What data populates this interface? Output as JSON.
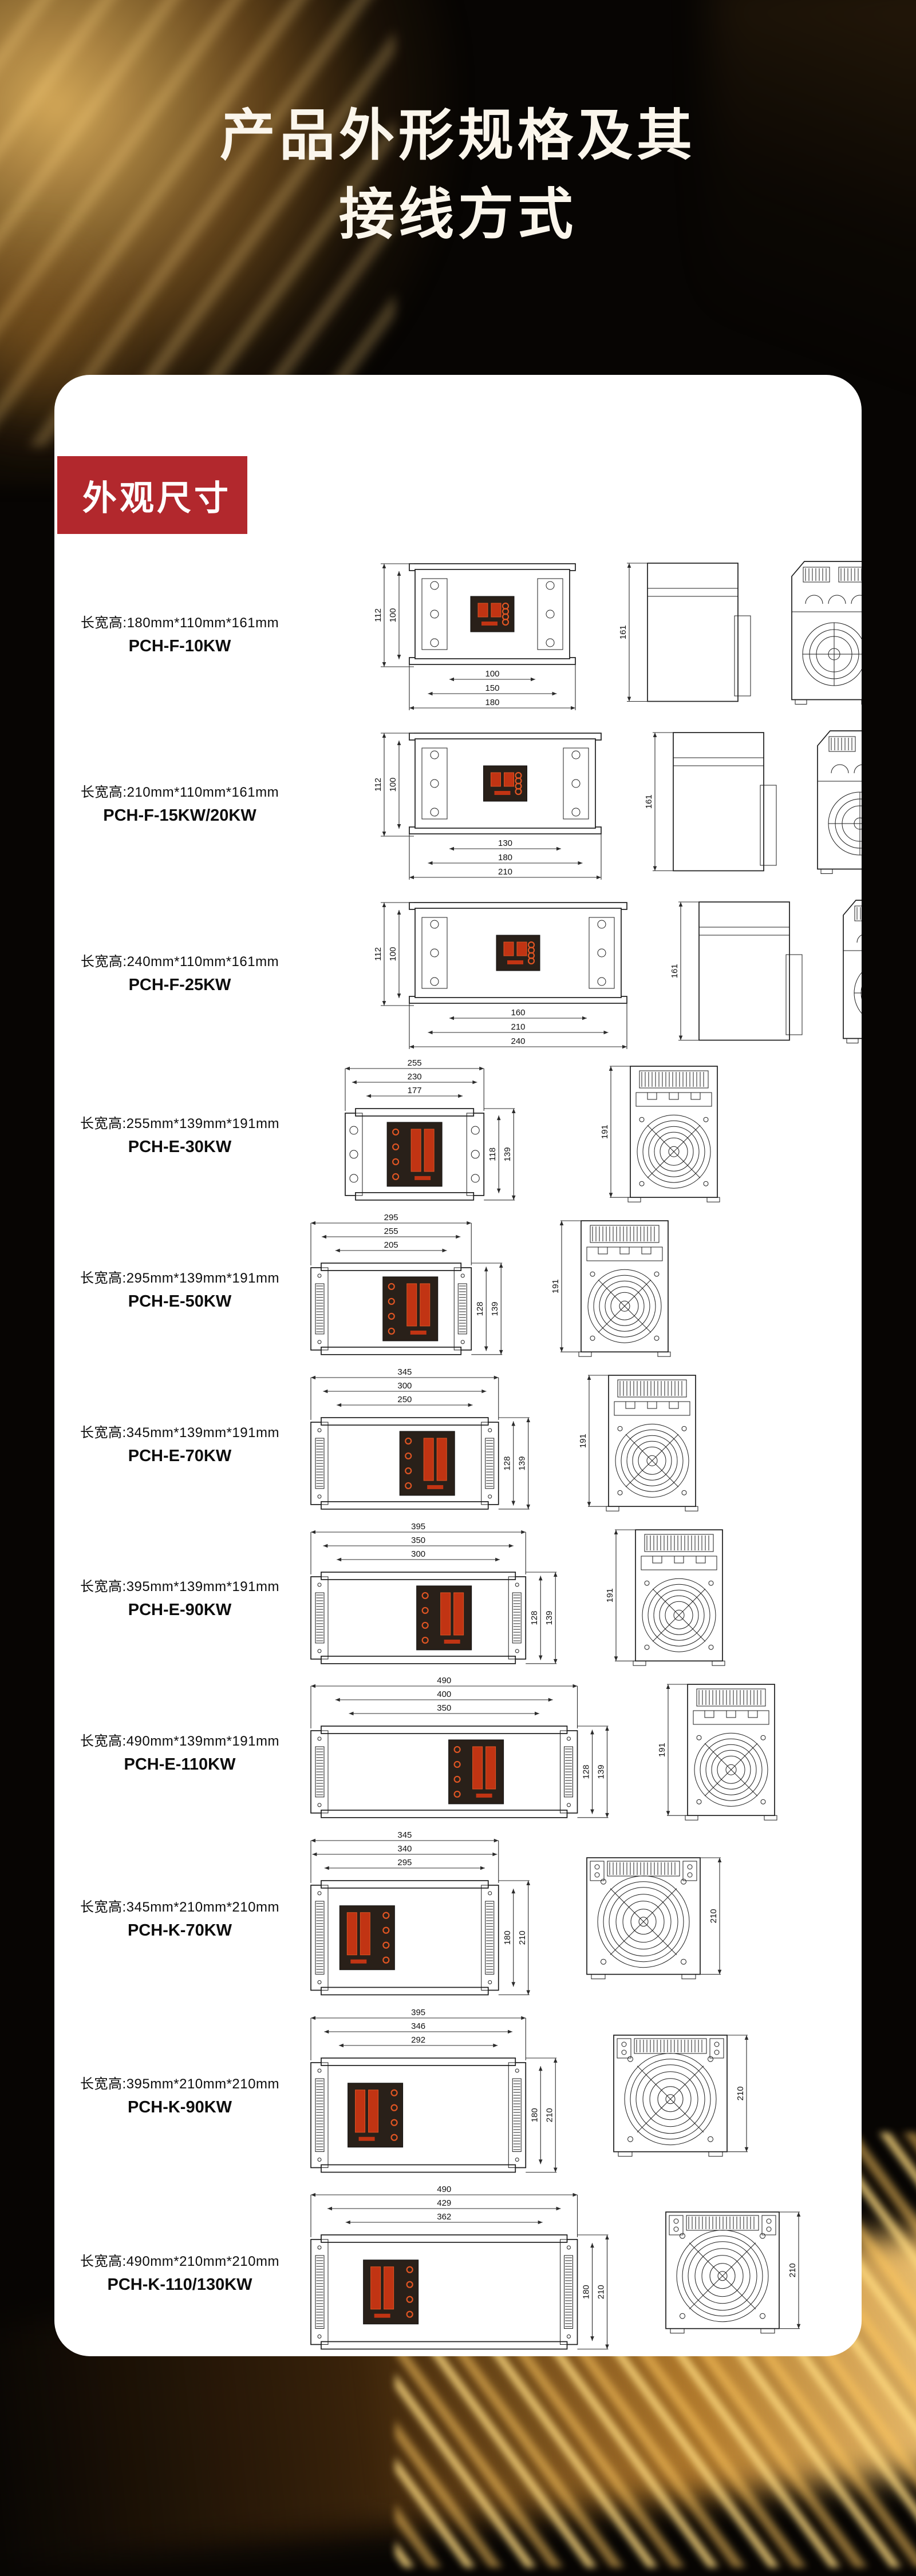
{
  "page": {
    "title_line1": "产品外形规格及其",
    "title_line2": "接线方式",
    "section_badge": "外观尺寸"
  },
  "colors": {
    "badge_red": "#b2282d",
    "panel_white": "#ffffff",
    "display_panel_dark": "#292019",
    "display_red": "#c13413",
    "display_red_bright": "#e05523",
    "gold_accent": "#e8b45e",
    "line_ink": "#1c1c1c"
  },
  "products": [
    {
      "label": "长宽高:180mm*110mm*161mm",
      "model": "PCH-F-10KW",
      "type": "F",
      "front": {
        "width_dims": [
          100,
          150,
          180
        ],
        "height_dims": [
          112,
          100
        ]
      },
      "side": {
        "height_dim": 161
      },
      "back": {
        "height_dim": 161
      }
    },
    {
      "label": "长宽高:210mm*110mm*161mm",
      "model": "PCH-F-15KW/20KW",
      "type": "F",
      "front": {
        "width_dims": [
          130,
          180,
          210
        ],
        "height_dims": [
          112,
          100
        ]
      },
      "side": {
        "height_dim": 161
      },
      "back": {
        "height_dim": 161
      }
    },
    {
      "label": "长宽高:240mm*110mm*161mm",
      "model": "PCH-F-25KW",
      "type": "F",
      "front": {
        "width_dims": [
          160,
          210,
          240
        ],
        "height_dims": [
          112,
          100
        ]
      },
      "side": {
        "height_dim": 161
      },
      "back": {
        "height_dim": 161
      }
    },
    {
      "label": "长宽高:255mm*139mm*191mm",
      "model": "PCH-E-30KW",
      "type": "E1",
      "front": {
        "width_dims": [
          255,
          230,
          177
        ],
        "height_dims": [
          118,
          139
        ]
      },
      "back": {
        "height_dim": 191
      }
    },
    {
      "label": "长宽高:295mm*139mm*191mm",
      "model": "PCH-E-50KW",
      "type": "E",
      "front": {
        "width_dims": [
          295,
          255,
          205
        ],
        "height_dims": [
          128,
          139
        ]
      },
      "back": {
        "height_dim": 191
      }
    },
    {
      "label": "长宽高:345mm*139mm*191mm",
      "model": "PCH-E-70KW",
      "type": "E",
      "front": {
        "width_dims": [
          345,
          300,
          250
        ],
        "height_dims": [
          128,
          139
        ]
      },
      "back": {
        "height_dim": 191
      }
    },
    {
      "label": "长宽高:395mm*139mm*191mm",
      "model": "PCH-E-90KW",
      "type": "E",
      "front": {
        "width_dims": [
          395,
          350,
          300
        ],
        "height_dims": [
          128,
          139
        ]
      },
      "back": {
        "height_dim": 191
      }
    },
    {
      "label": "长宽高:490mm*139mm*191mm",
      "model": "PCH-E-110KW",
      "type": "E",
      "front": {
        "width_dims": [
          490,
          400,
          350
        ],
        "height_dims": [
          128,
          139
        ]
      },
      "back": {
        "height_dim": 191
      }
    },
    {
      "label": "长宽高:345mm*210mm*210mm",
      "model": "PCH-K-70KW",
      "type": "K",
      "front": {
        "width_dims": [
          345,
          340,
          295
        ],
        "height_dims": [
          180,
          210
        ]
      },
      "back": {
        "height_dim": 210
      }
    },
    {
      "label": "长宽高:395mm*210mm*210mm",
      "model": "PCH-K-90KW",
      "type": "K",
      "front": {
        "width_dims": [
          395,
          346,
          292
        ],
        "height_dims": [
          180,
          210
        ]
      },
      "back": {
        "height_dim": 210
      }
    },
    {
      "label": "长宽高:490mm*210mm*210mm",
      "model": "PCH-K-110/130KW",
      "type": "K",
      "front": {
        "width_dims": [
          490,
          429,
          362
        ],
        "height_dims": [
          180,
          210
        ]
      },
      "back": {
        "height_dim": 210
      }
    }
  ]
}
